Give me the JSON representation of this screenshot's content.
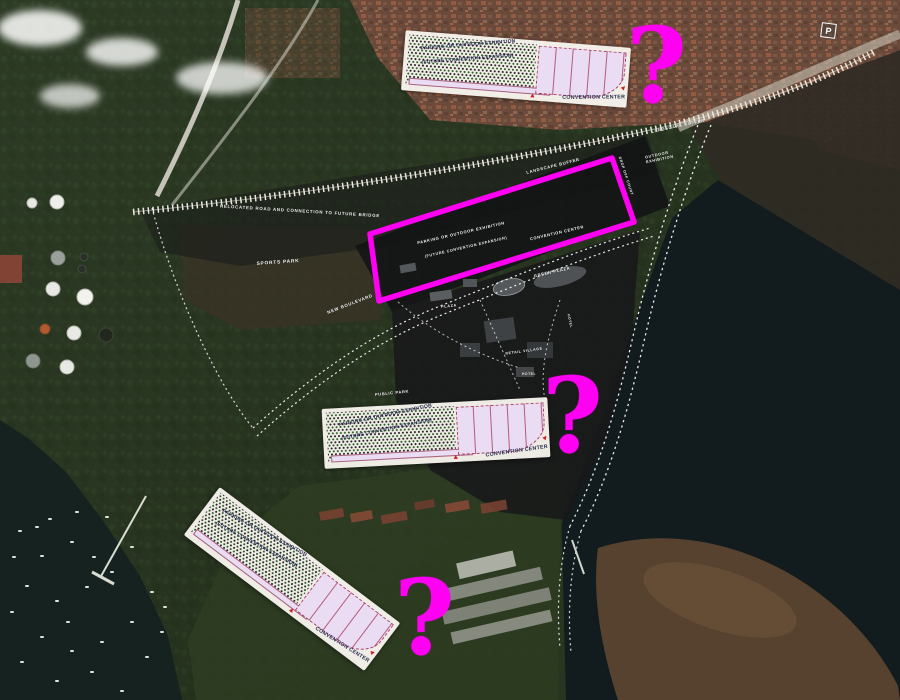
{
  "colors": {
    "highlight": "#ff00f2",
    "overlay_paper": "#f4f1e8",
    "overlay_hall": "#eadcf2",
    "plan_label": "#ffffff"
  },
  "question_marks": [
    {
      "glyph": "?"
    },
    {
      "glyph": "?"
    },
    {
      "glyph": "?"
    }
  ],
  "plan_overlays": [
    {
      "id": "north",
      "parking_label": "PARKING OR OUTDOOR EXHIBITION",
      "expansion_label": "(FUTURE CONVENTION EXPANSION)",
      "building_label": "CONVENTION CENTER"
    },
    {
      "id": "central",
      "parking_label": "PARKING OR OUTDOOR EXHIBITION",
      "expansion_label": "(FUTURE CONVENTION EXPANSION)",
      "building_label": "CONVENTION CENTER"
    },
    {
      "id": "south",
      "parking_label": "PARKING OR OUTDOOR EXHIBITION",
      "expansion_label": "(FUTURE CONVENTION EXPANSION)",
      "building_label": "CONVENTION CENTER"
    }
  ],
  "map_labels": {
    "relocated_road": "RELOCATED ROAD AND CONNECTION TO FUTURE BRIDGE",
    "sports_park": "SPORTS PARK",
    "new_boulevard": "NEW BOULEVARD",
    "public_park": "PUBLIC PARK",
    "landscape_buffer_inner": "LANDSCAPE BUFFER",
    "landscape_buffer_outer": "LANDSCAPE BUFFER",
    "outdoor_exhibition": "OUTDOOR EXHIBITION",
    "drop_off_court": "DROP OFF COURT",
    "site_parking": "PARKING OR OUTDOOR EXHIBITION",
    "site_expansion": "(FUTURE CONVENTION EXPANSION)",
    "site_convention_center": "CONVENTION CENTER",
    "green_plaza": "GREEN PLAZA",
    "plaza": "PLAZA",
    "retail_village": "RETAIL VILLAGE",
    "hotel_south": "HOTEL",
    "hotel_east": "HOTEL",
    "parking_sign": "P"
  }
}
